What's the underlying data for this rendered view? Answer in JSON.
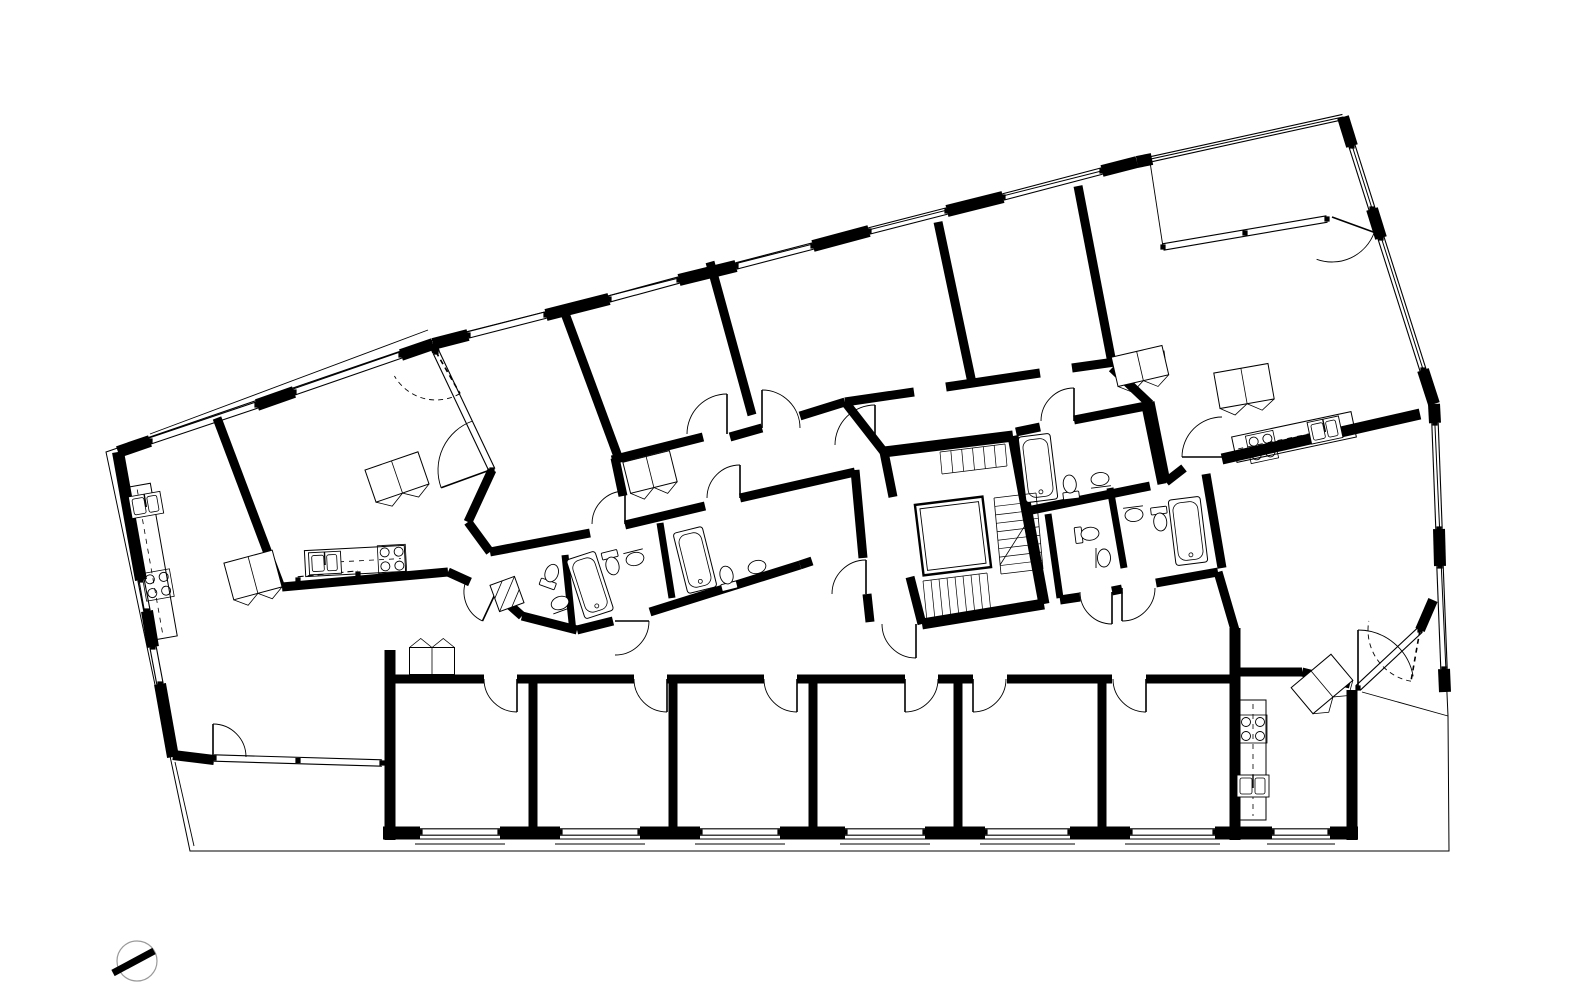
{
  "meta": {
    "title": "Apartment building floor plan",
    "canvas_w": 1580,
    "canvas_h": 998,
    "ink": "#000000",
    "paper": "#ffffff"
  },
  "plan": {
    "site_outline": [
      106,
      452,
      430,
      341,
      1137,
      162,
      1343,
      117,
      1434,
      404,
      1448,
      716,
      1449,
      851,
      190,
      851
    ],
    "thin_lines": [
      [
        150,
        434,
        428,
        330
      ],
      [
        175,
        762,
        194,
        846
      ],
      [
        1150,
        162,
        1163,
        247
      ],
      [
        1362,
        692,
        1448,
        716
      ]
    ],
    "walls": [
      [
        118,
        452,
        150,
        441,
        12
      ],
      [
        257,
        405,
        294,
        392,
        12
      ],
      [
        401,
        355,
        433,
        344,
        12
      ],
      [
        433,
        344,
        468,
        335,
        12
      ],
      [
        546,
        315,
        609,
        299,
        12
      ],
      [
        679,
        280,
        736,
        266,
        12
      ],
      [
        813,
        246,
        869,
        231,
        12
      ],
      [
        947,
        211,
        1003,
        197,
        12
      ],
      [
        1102,
        171,
        1137,
        162,
        12
      ],
      [
        1137,
        162,
        1152,
        159,
        12
      ],
      [
        1343,
        117,
        1352,
        146,
        12
      ],
      [
        1372,
        209,
        1381,
        238,
        12
      ],
      [
        1423,
        370,
        1434,
        404,
        12
      ],
      [
        1434,
        404,
        1435,
        423,
        12
      ],
      [
        1439,
        529,
        1440,
        566,
        12
      ],
      [
        1444,
        669,
        1445,
        692,
        12
      ],
      [
        118,
        452,
        141,
        580,
        12
      ],
      [
        147,
        611,
        153,
        647,
        12
      ],
      [
        160,
        684,
        173,
        757,
        12
      ],
      [
        173,
        755,
        214,
        760,
        10
      ],
      [
        383,
        833,
        420,
        833,
        13
      ],
      [
        500,
        833,
        560,
        833,
        13
      ],
      [
        640,
        833,
        700,
        833,
        13
      ],
      [
        780,
        833,
        845,
        833,
        13
      ],
      [
        925,
        833,
        985,
        833,
        13
      ],
      [
        1070,
        833,
        1130,
        833,
        13
      ],
      [
        1215,
        833,
        1272,
        833,
        13
      ],
      [
        1330,
        833,
        1358,
        833,
        13
      ],
      [
        533,
        683,
        533,
        833,
        9
      ],
      [
        673,
        683,
        673,
        833,
        9
      ],
      [
        813,
        683,
        813,
        833,
        9
      ],
      [
        958,
        683,
        958,
        833,
        9
      ],
      [
        1102,
        683,
        1102,
        833,
        9
      ],
      [
        390,
        650,
        390,
        840,
        11
      ],
      [
        385,
        679,
        484,
        679,
        9
      ],
      [
        517,
        679,
        634,
        679,
        9
      ],
      [
        667,
        679,
        764,
        679,
        9
      ],
      [
        797,
        679,
        905,
        679,
        9
      ],
      [
        938,
        679,
        973,
        679,
        9
      ],
      [
        1007,
        679,
        1112,
        679,
        9
      ],
      [
        1146,
        679,
        1235,
        679,
        9
      ],
      [
        1235,
        628,
        1235,
        840,
        11
      ],
      [
        1352,
        690,
        1352,
        840,
        11
      ],
      [
        1235,
        672,
        1302,
        672,
        9
      ],
      [
        1302,
        672,
        1350,
        684,
        9
      ],
      [
        1218,
        572,
        1235,
        630,
        9
      ],
      [
        1420,
        630,
        1433,
        600,
        10
      ],
      [
        217,
        418,
        280,
        585,
        9
      ],
      [
        563,
        308,
        620,
        462,
        9
      ],
      [
        710,
        262,
        752,
        415,
        9
      ],
      [
        938,
        222,
        972,
        383,
        9
      ],
      [
        1078,
        186,
        1112,
        363,
        9
      ],
      [
        615,
        458,
        623,
        496,
        9
      ],
      [
        612,
        460,
        703,
        437,
        9
      ],
      [
        730,
        437,
        762,
        428,
        9
      ],
      [
        800,
        416,
        845,
        402,
        9
      ],
      [
        845,
        402,
        884,
        452,
        9
      ],
      [
        845,
        402,
        914,
        392,
        9
      ],
      [
        946,
        387,
        1040,
        373,
        9
      ],
      [
        1072,
        368,
        1165,
        355,
        9
      ],
      [
        282,
        587,
        448,
        572,
        9
      ],
      [
        492,
        470,
        468,
        522,
        9
      ],
      [
        468,
        522,
        490,
        552,
        9
      ],
      [
        448,
        572,
        470,
        582,
        9
      ],
      [
        496,
        593,
        522,
        616,
        9
      ],
      [
        490,
        552,
        590,
        533,
        9
      ],
      [
        625,
        525,
        705,
        506,
        9
      ],
      [
        740,
        498,
        855,
        472,
        9
      ],
      [
        522,
        616,
        577,
        630,
        9
      ],
      [
        577,
        630,
        613,
        621,
        9
      ],
      [
        650,
        612,
        800,
        565,
        9
      ],
      [
        800,
        565,
        812,
        561,
        9
      ],
      [
        565,
        555,
        573,
        632,
        7
      ],
      [
        660,
        523,
        672,
        598,
        7
      ],
      [
        855,
        470,
        863,
        558,
        9
      ],
      [
        867,
        594,
        870,
        622,
        9
      ],
      [
        884,
        452,
        1013,
        436,
        11
      ],
      [
        1013,
        436,
        1044,
        604,
        11
      ],
      [
        1044,
        604,
        922,
        624,
        11
      ],
      [
        884,
        452,
        893,
        497,
        9
      ],
      [
        910,
        577,
        922,
        624,
        9
      ],
      [
        1016,
        432,
        1040,
        427,
        9
      ],
      [
        1074,
        420,
        1146,
        406,
        9
      ],
      [
        1146,
        406,
        1162,
        484,
        9
      ],
      [
        1022,
        512,
        1150,
        486,
        9
      ],
      [
        1110,
        488,
        1124,
        568,
        7
      ],
      [
        1048,
        514,
        1060,
        598,
        7
      ],
      [
        1206,
        474,
        1222,
        568,
        9
      ],
      [
        1060,
        600,
        1080,
        597,
        9
      ],
      [
        1112,
        591,
        1122,
        589,
        9
      ],
      [
        1156,
        583,
        1218,
        572,
        9
      ],
      [
        1150,
        402,
        1166,
        482,
        9
      ],
      [
        1166,
        482,
        1184,
        468,
        9
      ],
      [
        1222,
        459,
        1420,
        414,
        11
      ],
      [
        1112,
        368,
        1150,
        404,
        9
      ],
      [
        436,
        352,
        433,
        344,
        8
      ]
    ],
    "windows": [
      {
        "p": [
          150,
          441,
          257,
          405
        ]
      },
      {
        "p": [
          294,
          392,
          401,
          355
        ]
      },
      {
        "p": [
          468,
          335,
          546,
          315
        ]
      },
      {
        "p": [
          609,
          299,
          679,
          280
        ]
      },
      {
        "p": [
          736,
          266,
          813,
          246
        ]
      },
      {
        "p": [
          869,
          231,
          947,
          211
        ]
      },
      {
        "p": [
          1003,
          197,
          1102,
          171
        ]
      },
      {
        "p": [
          1152,
          159,
          1343,
          117
        ],
        "rail": true
      },
      {
        "p": [
          1352,
          146,
          1372,
          209
        ]
      },
      {
        "p": [
          1381,
          238,
          1423,
          370
        ]
      },
      {
        "p": [
          1435,
          423,
          1439,
          529
        ]
      },
      {
        "p": [
          1440,
          566,
          1444,
          669
        ]
      },
      {
        "p": [
          141,
          580,
          147,
          611
        ]
      },
      {
        "p": [
          153,
          647,
          160,
          684
        ]
      },
      {
        "p": [
          214,
          758,
          382,
          763
        ],
        "mullions": true
      },
      {
        "p": [
          420,
          832,
          500,
          832
        ],
        "sill": 1
      },
      {
        "p": [
          560,
          832,
          640,
          832
        ],
        "sill": 1
      },
      {
        "p": [
          700,
          832,
          780,
          832
        ],
        "sill": 1
      },
      {
        "p": [
          845,
          832,
          925,
          832
        ],
        "sill": 1
      },
      {
        "p": [
          985,
          832,
          1070,
          832
        ],
        "sill": 1
      },
      {
        "p": [
          1130,
          832,
          1215,
          832
        ],
        "sill": 1
      },
      {
        "p": [
          1272,
          832,
          1330,
          832
        ],
        "sill": 1
      },
      {
        "p": [
          436,
          352,
          492,
          470
        ]
      },
      {
        "p": [
          1358,
          688,
          1420,
          630
        ]
      },
      {
        "p": [
          1163,
          247,
          1327,
          219
        ],
        "mullions": true
      },
      {
        "p": [
          298,
          580,
          358,
          574
        ],
        "dashed": true
      }
    ],
    "doors": [
      {
        "h": [
          517,
          679
        ],
        "r": 33,
        "a": [
          90,
          180
        ]
      },
      {
        "h": [
          667,
          679
        ],
        "r": 33,
        "a": [
          90,
          180
        ]
      },
      {
        "h": [
          797,
          679
        ],
        "r": 33,
        "a": [
          90,
          180
        ]
      },
      {
        "h": [
          905,
          679
        ],
        "r": 33,
        "a": [
          90,
          0
        ]
      },
      {
        "h": [
          973,
          679
        ],
        "r": 33,
        "a": [
          90,
          0
        ]
      },
      {
        "h": [
          1146,
          679
        ],
        "r": 33,
        "a": [
          90,
          180
        ]
      },
      {
        "h": [
          615,
          621
        ],
        "r": 34,
        "a": [
          0,
          90
        ]
      },
      {
        "h": [
          213,
          757
        ],
        "r": 33,
        "a": [
          270,
          0
        ]
      },
      {
        "h": [
          496,
          592
        ],
        "r": 32,
        "a": [
          115,
          205
        ]
      },
      {
        "h": [
          625,
          524
        ],
        "r": 33,
        "a": [
          270,
          180
        ]
      },
      {
        "h": [
          740,
          498
        ],
        "r": 33,
        "a": [
          270,
          180
        ]
      },
      {
        "h": [
          727,
          434
        ],
        "r": 40,
        "a": [
          270,
          180
        ]
      },
      {
        "h": [
          762,
          428
        ],
        "r": 38,
        "a": [
          270,
          0
        ]
      },
      {
        "h": [
          875,
          445
        ],
        "r": 40,
        "a": [
          270,
          180
        ]
      },
      {
        "h": [
          866,
          594
        ],
        "r": 34,
        "a": [
          270,
          180
        ]
      },
      {
        "h": [
          916,
          624
        ],
        "r": 34,
        "a": [
          90,
          180
        ]
      },
      {
        "h": [
          1074,
          421
        ],
        "r": 33,
        "a": [
          270,
          180
        ]
      },
      {
        "h": [
          1112,
          592
        ],
        "r": 32,
        "a": [
          90,
          180
        ]
      },
      {
        "h": [
          1122,
          588
        ],
        "r": 33,
        "a": [
          90,
          0
        ]
      },
      {
        "h": [
          1222,
          457
        ],
        "r": 40,
        "a": [
          180,
          270
        ]
      },
      {
        "h": [
          1332,
          217
        ],
        "r": 45,
        "a": [
          20,
          110
        ]
      },
      {
        "h": [
          490,
          470
        ],
        "r": 52,
        "a": [
          160,
          250
        ]
      },
      {
        "h": [
          436,
          352
        ],
        "r": 48,
        "a": [
          60,
          150
        ],
        "dashed": true
      },
      {
        "h": [
          1358,
          686
        ],
        "r": 56,
        "a": [
          270,
          350
        ]
      },
      {
        "h": [
          1420,
          630
        ],
        "r": 52,
        "a": [
          100,
          190
        ],
        "dashed": true
      }
    ],
    "tubs": [
      [
        590,
        585,
        30,
        62,
        -18
      ],
      [
        695,
        560,
        30,
        62,
        -14
      ],
      [
        1038,
        468,
        32,
        66,
        -7
      ],
      [
        1188,
        531,
        32,
        66,
        -7
      ]
    ],
    "toilets": [
      [
        551,
        575,
        200
      ],
      [
        612,
        564,
        -14
      ],
      [
        727,
        577,
        166
      ],
      [
        1070,
        486,
        173
      ],
      [
        1088,
        534,
        -97
      ],
      [
        1160,
        520,
        -7
      ]
    ],
    "sinks": [
      [
        560,
        603,
        160
      ],
      [
        635,
        559,
        -14
      ],
      [
        757,
        567,
        166
      ],
      [
        1100,
        479,
        173
      ],
      [
        1104,
        558,
        -90
      ],
      [
        1134,
        515,
        -7
      ]
    ],
    "kitchen_sinks": [
      [
        146,
        505,
        -10
      ],
      [
        325,
        563,
        -3
      ],
      [
        1325,
        430,
        -12
      ],
      [
        1253,
        786,
        0
      ]
    ],
    "stoves": [
      [
        158,
        585,
        -10
      ],
      [
        392,
        559,
        -3
      ],
      [
        1262,
        447,
        -12
      ],
      [
        1253,
        729,
        0
      ]
    ],
    "counters": [
      [
        150,
        562,
        28,
        155,
        -10
      ],
      [
        355,
        561,
        100,
        26,
        -3
      ],
      [
        1294,
        437,
        122,
        26,
        -12
      ],
      [
        1253,
        760,
        26,
        120,
        0
      ]
    ],
    "wardrobes": [
      [
        432,
        661,
        45,
        27,
        0,
        "up"
      ],
      [
        1140,
        366,
        52,
        30,
        -13,
        "down"
      ],
      [
        397,
        477,
        56,
        34,
        -19,
        "down"
      ],
      [
        253,
        575,
        50,
        38,
        -15,
        "down"
      ],
      [
        1322,
        684,
        52,
        34,
        -40,
        "down"
      ],
      [
        650,
        472,
        48,
        32,
        -14,
        "down"
      ],
      [
        1244,
        386,
        55,
        36,
        -10,
        "down"
      ]
    ],
    "shaft": [
      494,
      580,
      26,
      28,
      -20
    ],
    "elevator": [
      953,
      536,
      68,
      71,
      -7
    ],
    "stairs": {
      "flights": [
        {
          "r1": [
            994,
            498,
            1001,
            574
          ],
          "r2": [
            1036,
            493,
            1043,
            569
          ],
          "n": 9
        },
        {
          "r1": [
            940,
            452,
            1005,
            444
          ],
          "r2": [
            942,
            474,
            1007,
            466
          ],
          "n": 6
        },
        {
          "r1": [
            923,
            581,
            987,
            573
          ],
          "r2": [
            927,
            621,
            991,
            613
          ],
          "n": 8
        }
      ],
      "stringer": [
        1000,
        565,
        1038,
        505
      ]
    },
    "north_arrow": {
      "circle": [
        137,
        961,
        20
      ],
      "needle": [
        154,
        951,
        113,
        973,
        7
      ]
    }
  }
}
